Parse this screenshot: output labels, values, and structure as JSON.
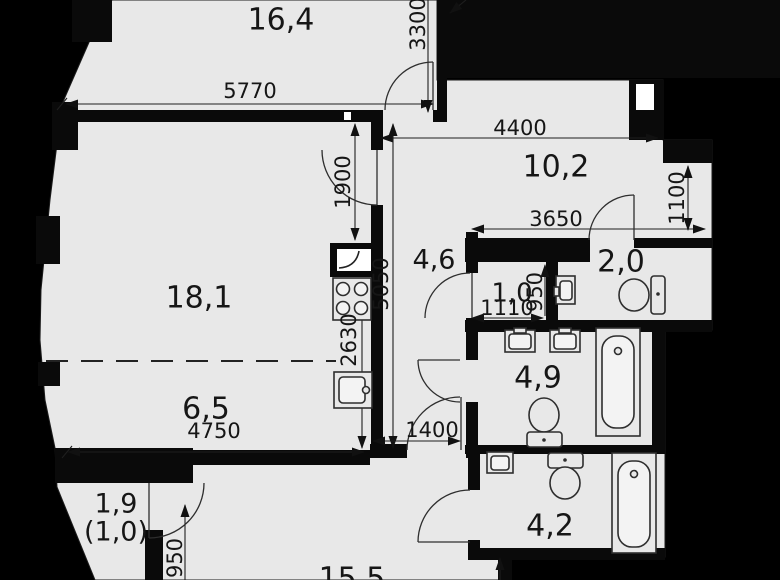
{
  "plan_title": "apartment-floor-plan",
  "colors": {
    "background": "#000000",
    "floor": "#e8e8e8",
    "wall": "#0a0a0a",
    "line": "#2e2e2e",
    "text": "#161616",
    "notch_white": "#ffffff"
  },
  "rooms": {
    "room_16_4": "16,4",
    "room_18_1": "18,1",
    "room_6_5": "6,5",
    "room_10_2": "10,2",
    "room_4_6": "4,6",
    "room_1_0": "1,0",
    "room_2_0": "2,0",
    "room_4_9": "4,9",
    "room_4_2": "4,2",
    "balcony_area": "1,9",
    "balcony_reduced": "(1,0)",
    "room_15_5": "15,5"
  },
  "dimensions": {
    "d5770": "5770",
    "d3300": "3300",
    "d4400": "4400",
    "d1900": "1900",
    "d3650": "3650",
    "d1100": "1100",
    "d5050": "5050",
    "d950_storage": "950",
    "d1110": "1110",
    "d2630": "2630",
    "d4750": "4750",
    "d1400": "1400",
    "d950_balcony": "950"
  },
  "fixtures": {
    "electric_panel": "electric-panel-icon",
    "stove": "stove-4-burner-icon",
    "kitchen_sink": "kitchen-sink-icon",
    "washbasin": "washbasin-icon",
    "toilet": "toilet-icon",
    "bathtub": "bathtub-icon"
  }
}
